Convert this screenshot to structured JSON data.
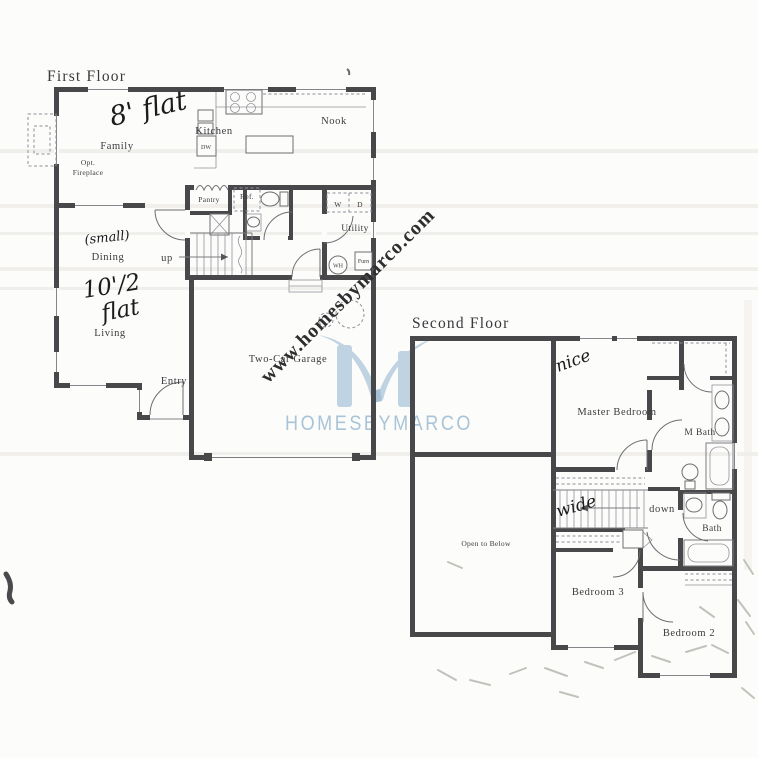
{
  "watermarks": {
    "diagonal_text": "www.homesbymarco.com",
    "brand": "HOMESBYMARCO",
    "brand_color": "#a9c4d7",
    "logo_color": "#bad0e0"
  },
  "first_floor": {
    "title": "First Floor",
    "rooms": {
      "family": "Family",
      "kitchen": "Kitchen",
      "nook": "Nook",
      "dining": "Dining",
      "living": "Living",
      "entry": "Entry",
      "utility": "Utility",
      "pantry": "Pantry",
      "garage": "Two-Car Garage"
    },
    "fixtures": {
      "dw": "DW",
      "ref": "Ref.",
      "washer": "W",
      "dryer": "D",
      "water_heater": "WH",
      "furnace": "Furn",
      "opt_fireplace_line1": "Opt.",
      "opt_fireplace_line2": "Fireplace"
    },
    "stairs": {
      "up": "up"
    },
    "handwritten": {
      "family_ceiling": "8' flat",
      "dining_note": "(small)",
      "living_ceiling_line1": "10'/2",
      "living_ceiling_line2": "flat"
    }
  },
  "second_floor": {
    "title": "Second Floor",
    "rooms": {
      "master": "Master Bedroom",
      "master_bath": "M Bath",
      "bath": "Bath",
      "bedroom3": "Bedroom 3",
      "bedroom2": "Bedroom 2",
      "open_to_below": "Open to Below"
    },
    "stairs": {
      "down": "down"
    },
    "handwritten": {
      "master_note": "nice",
      "stairs_note": "wide"
    }
  }
}
